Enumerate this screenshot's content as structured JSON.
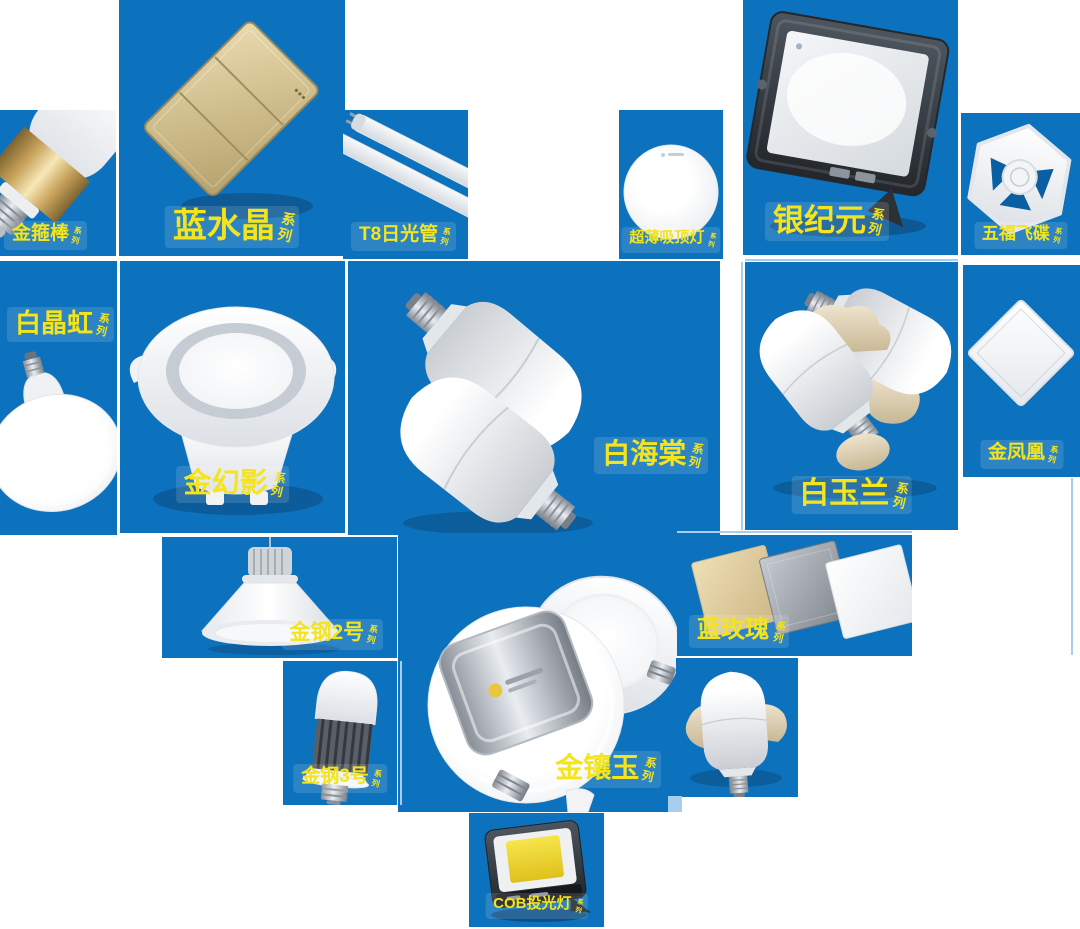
{
  "page": {
    "background_color": "#ffffff",
    "tile_color": "#0d72bd",
    "label_color": "#f3e41e",
    "accent_line_color": "#a9cdec"
  },
  "tiles": [
    {
      "id": "jin-gu-bang",
      "label": "金箍棒",
      "suffix": "系列",
      "product": "stick-bulb-gold-band"
    },
    {
      "id": "lan-shui-jing",
      "label": "蓝水晶",
      "suffix": "系列",
      "product": "gold-wall-switch-panel"
    },
    {
      "id": "t8-ri-guang-guan",
      "label": "T8日光管",
      "suffix": "系列",
      "product": "led-tube-lights"
    },
    {
      "id": "chao-bao-xi-ding-deng",
      "label": "超薄吸顶灯",
      "suffix": "系列",
      "product": "slim-round-ceiling-lamp"
    },
    {
      "id": "yin-ji-yuan",
      "label": "银纪元",
      "suffix": "系列",
      "product": "led-flood-light"
    },
    {
      "id": "wu-fu-fei-die",
      "label": "五福飞碟",
      "suffix": "系列",
      "product": "hexagon-ufo-lamp"
    },
    {
      "id": "bai-jing-hong",
      "label": "白晶虹",
      "suffix": "系列",
      "product": "ufo-disc-bulb"
    },
    {
      "id": "jin-huan-ying",
      "label": "金幻影",
      "suffix": "系列",
      "product": "recessed-downlight"
    },
    {
      "id": "bai-hai-tang",
      "label": "白海棠",
      "suffix": "系列",
      "product": "t-shape-bulbs"
    },
    {
      "id": "bai-yu-lan",
      "label": "白玉兰",
      "suffix": "系列",
      "product": "t-shape-bulbs-with-stones"
    },
    {
      "id": "jin-feng-huang",
      "label": "金凤凰",
      "suffix": "系列",
      "product": "square-panel-light"
    },
    {
      "id": "jin-gang-2",
      "label": "金钢2号",
      "suffix": "系列",
      "product": "highbay-light"
    },
    {
      "id": "jin-xiang-yu",
      "label": "金镶玉",
      "suffix": "系列",
      "product": "round-downlights"
    },
    {
      "id": "lan-mei-gui",
      "label": "蓝玫瑰",
      "suffix": "系列",
      "product": "three-square-panels"
    },
    {
      "id": "jin-gang-3",
      "label": "金钢3号",
      "suffix": "系列",
      "product": "high-power-fin-bulb"
    },
    {
      "id": "bulb-on-stone",
      "label": "",
      "suffix": "",
      "product": "t-shape-bulb-on-stone"
    },
    {
      "id": "cob-tou-guang-deng",
      "label": "COB投光灯",
      "suffix": "系列",
      "product": "cob-flood-light"
    }
  ]
}
